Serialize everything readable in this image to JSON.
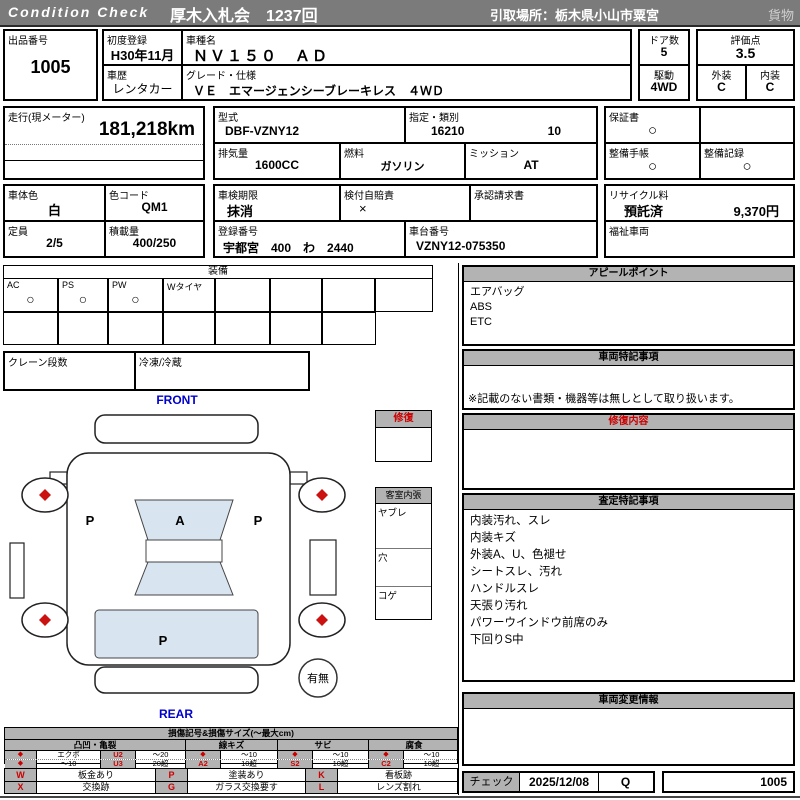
{
  "colors": {
    "bar": "#7b7b7b",
    "section_gray": "#b3b3b3",
    "accent_red": "#cc0000",
    "label_blue": "#0000cc",
    "glass_blue": "#d8e5f1"
  },
  "header": {
    "brand": "Condition Check",
    "auction": "厚木入札会　1237回",
    "pickup": "引取場所：栃木県小山市粟宮",
    "category": "貨物"
  },
  "info": {
    "lot_label": "出品番号",
    "lot": "1005",
    "first_reg_label": "初度登録",
    "first_reg": "H30年11月",
    "model_label": "車種名",
    "model": "ＮＶ１５０　ＡＤ",
    "history_label": "車歴",
    "history": "レンタカー",
    "grade_label": "グレード・仕様",
    "grade": "ＶＥ　エマージェンシーブレーキレス　４ＷＤ",
    "doors_label": "ドア数",
    "doors": "5",
    "drive_label": "駆動",
    "drive": "4WD",
    "score_label": "評価点",
    "score": "3.5",
    "exterior_label": "外装",
    "exterior": "C",
    "interior_label": "内装",
    "interior": "C",
    "mileage_label": "走行(現メーター)",
    "mileage": "181,218km",
    "type_label": "型式",
    "type_code": "DBF-VZNY12",
    "class_label": "指定・類別",
    "class_no": "16210",
    "class_sub": "10",
    "warranty_label": "保証書",
    "warranty": "○",
    "displacement_label": "排気量",
    "displacement": "1600CC",
    "fuel_label": "燃料",
    "fuel": "ガソリン",
    "transmission_label": "ミッション",
    "transmission": "AT",
    "maintenance_book_label": "整備手帳",
    "maintenance_book": "○",
    "maintenance_record_label": "整備記録",
    "maintenance_record": "○",
    "body_color_label": "車体色",
    "body_color": "白",
    "color_code_label": "色コード",
    "color_code": "QM1",
    "inspection_label": "車検期限",
    "inspection": "抹消",
    "insurance_label": "検付自賠責",
    "insurance": "×",
    "approval_label": "承認請求書",
    "recycle_label": "リサイクル料",
    "recycle_status": "預託済",
    "recycle_fee": "9,370円",
    "capacity_label": "定員",
    "capacity": "2/5",
    "load_label": "積載量",
    "load": "400/250",
    "plate_label": "登録番号",
    "plate": "宇都宮　400　わ　2440",
    "vin_label": "車台番号",
    "vin": "VZNY12-075350",
    "welfare_label": "福祉車両"
  },
  "equipment": {
    "title": "装備",
    "items": [
      {
        "label": "AC",
        "value": "○"
      },
      {
        "label": "PS",
        "value": "○"
      },
      {
        "label": "PW",
        "value": "○"
      },
      {
        "label": "Wタイヤ",
        "value": ""
      },
      {
        "label": "",
        "value": ""
      },
      {
        "label": "",
        "value": ""
      },
      {
        "label": "",
        "value": ""
      },
      {
        "label": "",
        "value": ""
      }
    ],
    "crane_label": "クレーン段数",
    "fridge_label": "冷凍/冷蔵"
  },
  "panels": {
    "appeal": {
      "title": "アピールポイント",
      "lines": [
        "エアバッグ",
        "ABS",
        "ETC"
      ]
    },
    "vehicle_notes": {
      "title": "車両特記事項",
      "note": "※記載のない書類・機器等は無しとして取り扱います。"
    },
    "repair": {
      "title": "修復内容"
    },
    "assessment": {
      "title": "査定特記事項",
      "lines": [
        "内装汚れ、スレ",
        "内装キズ",
        "外装A、U、色褪せ",
        "シートスレ、汚れ",
        "ハンドルスレ",
        "天張り汚れ",
        "パワーウインドウ前席のみ",
        "下回りS中"
      ]
    },
    "change_info": {
      "title": "車両変更情報"
    }
  },
  "diagram": {
    "front_label": "FRONT",
    "rear_label": "REAR",
    "repair_box_title": "修復",
    "cabin": {
      "title": "客室内張",
      "items": [
        "ヤブレ",
        "穴",
        "コゲ"
      ]
    },
    "marks": {
      "windshield": "A",
      "left_door": "P",
      "right_door": "P",
      "cargo": "P"
    },
    "presence": "有無"
  },
  "legend": {
    "title": "損傷記号&損傷サイズ(～最大cm)",
    "groups": [
      {
        "name": "凸凹・亀裂",
        "r1": [
          "◆",
          "エクボ",
          "U2",
          "～20"
        ],
        "r2": [
          "◆",
          "～10",
          "U3",
          "20超"
        ]
      },
      {
        "name": "線キズ",
        "r1": [
          "◆",
          "～10"
        ],
        "r2": [
          "A2",
          "10超"
        ]
      },
      {
        "name": "サビ",
        "r1": [
          "◆",
          "～10"
        ],
        "r2": [
          "S2",
          "10超"
        ]
      },
      {
        "name": "腐食",
        "r1": [
          "◆",
          "～10"
        ],
        "r2": [
          "C2",
          "10超"
        ]
      }
    ],
    "codes": {
      "r1": [
        "W",
        "板金あり",
        "P",
        "塗装あり",
        "K",
        "看板跡"
      ],
      "r2": [
        "X",
        "交換跡",
        "G",
        "ガラス交換要す",
        "L",
        "レンズ割れ"
      ]
    }
  },
  "check": {
    "label": "チェック",
    "date": "2025/12/08",
    "inspector": "Q",
    "lot": "1005"
  }
}
